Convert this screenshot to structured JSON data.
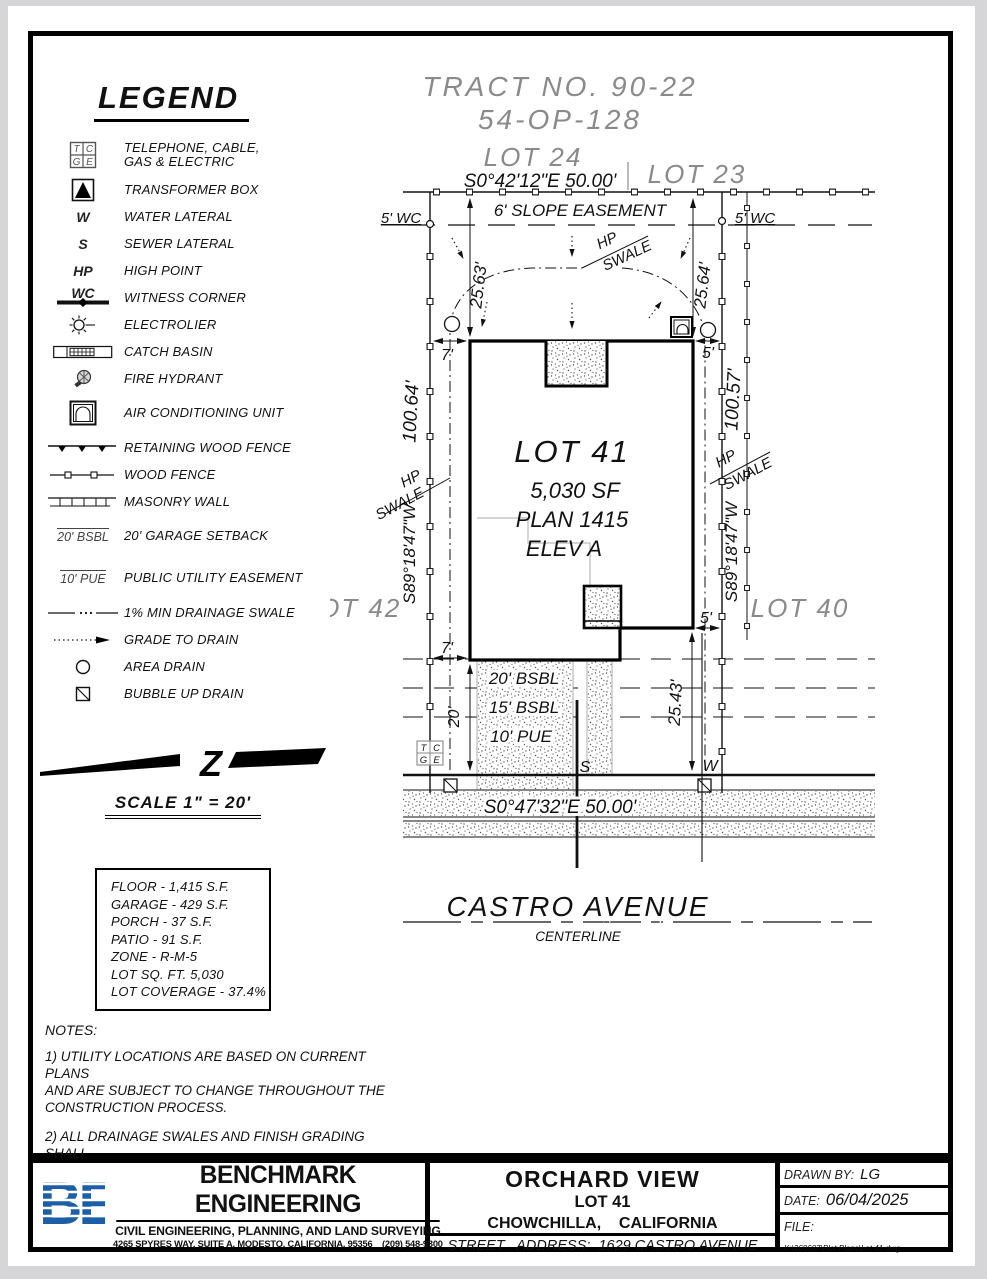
{
  "legend": {
    "title": "LEGEND",
    "items": [
      {
        "sym": "",
        "label": "TELEPHONE, CABLE,\nGAS & ELECTRIC"
      },
      {
        "sym": "",
        "label": "TRANSFORMER BOX"
      },
      {
        "sym": "W",
        "label": "WATER LATERAL"
      },
      {
        "sym": "S",
        "label": "SEWER LATERAL"
      },
      {
        "sym": "HP",
        "label": "HIGH POINT"
      },
      {
        "sym": "WC",
        "label": "WITNESS CORNER"
      },
      {
        "sym": "",
        "label": "ELECTROLIER"
      },
      {
        "sym": "",
        "label": "CATCH BASIN"
      },
      {
        "sym": "",
        "label": "FIRE HYDRANT"
      },
      {
        "sym": "",
        "label": "AIR CONDITIONING UNIT"
      },
      {
        "sym": "",
        "label": "RETAINING WOOD FENCE"
      },
      {
        "sym": "",
        "label": "WOOD FENCE"
      },
      {
        "sym": "",
        "label": "MASONRY WALL"
      },
      {
        "sym": "20' BSBL",
        "label": "20' GARAGE SETBACK"
      },
      {
        "sym": "10' PUE",
        "label": "PUBLIC UTILITY EASEMENT"
      },
      {
        "sym": "",
        "label": "1% MIN DRAINAGE SWALE"
      },
      {
        "sym": "",
        "label": "GRADE TO DRAIN"
      },
      {
        "sym": "",
        "label": "AREA DRAIN"
      },
      {
        "sym": "",
        "label": "BUBBLE UP DRAIN"
      }
    ]
  },
  "scale": {
    "label": "SCALE 1\" = 20'"
  },
  "stats": {
    "lines": [
      "FLOOR - 1,415 S.F.",
      "GARAGE - 429 S.F.",
      "PORCH - 37 S.F.",
      "PATIO - 91 S.F.",
      "ZONE - R-M-5",
      "LOT SQ. FT. 5,030",
      "LOT COVERAGE - 37.4%"
    ]
  },
  "notes": {
    "title": "NOTES:",
    "n1": "1) UTILITY LOCATIONS ARE BASED ON CURRENT PLANS\nAND ARE SUBJECT TO CHANGE THROUGHOUT THE\nCONSTRUCTION PROCESS.",
    "n2": "2) ALL DRAINAGE SWALES AND FINISH GRADING SHALL\nCONFORM TO F.H.A. STANDARDS."
  },
  "plan": {
    "tract_no": "TRACT NO. 90-22",
    "map_ref": "54-OP-128",
    "lots": {
      "lot24": "LOT 24",
      "lot23": "LOT 23",
      "lot42": "LOT 42",
      "lot40": "LOT 40"
    },
    "north_bearing": "S0°42'12\"E  50.00'",
    "south_bearing": "S0°47'32\"E  50.00'",
    "west_bearing": "S89°18'47\"W",
    "east_bearing": "S89°18'47\"W",
    "slope_easement": "6' SLOPE EASEMENT",
    "wc": "5' WC",
    "dims": {
      "d2563": "25.63'",
      "d2564": "25.64'",
      "d10064": "100.64'",
      "d10057": "100.57'",
      "d2543": "25.43'",
      "d7": "7'",
      "d5": "5'",
      "d20": "20'"
    },
    "lot41": {
      "name": "LOT 41",
      "area": "5,030 SF",
      "plan": "PLAN 1415",
      "elev": "ELEV A"
    },
    "sb20": "20' BSBL",
    "sb15": "15' BSBL",
    "pue10": "10' PUE",
    "hp": "HP",
    "swale": "SWALE",
    "s": "S",
    "w": "W",
    "ub": {
      "t": "T",
      "c": "C",
      "g": "G",
      "e": "E"
    },
    "street": {
      "name": "CASTRO AVENUE",
      "centerline": "CENTERLINE"
    }
  },
  "titleblock": {
    "company": {
      "logo": "BE",
      "name": "BENCHMARK ENGINEERING",
      "tagline": "CIVIL ENGINEERING, PLANNING, AND LAND SURVEYING",
      "address": "4265 SPYRES WAY, SUITE A, MODESTO, CALIFORNIA, 95356    (209) 548-9300"
    },
    "project": {
      "name": "ORCHARD VIEW",
      "lot": "LOT 41",
      "city": "CHOWCHILLA,    CALIFORNIA",
      "street_address": "STREET   ADDRESS:  1629 CASTRO AVENUE"
    },
    "meta": {
      "drawn_by_label": "DRAWN BY:",
      "drawn_by": "LG",
      "date_label": "DATE:",
      "date": "06/04/2025",
      "file_label": "FILE:",
      "file_path": "K:\\260607\\Plot Plans\\Lot 41.dwg"
    }
  }
}
